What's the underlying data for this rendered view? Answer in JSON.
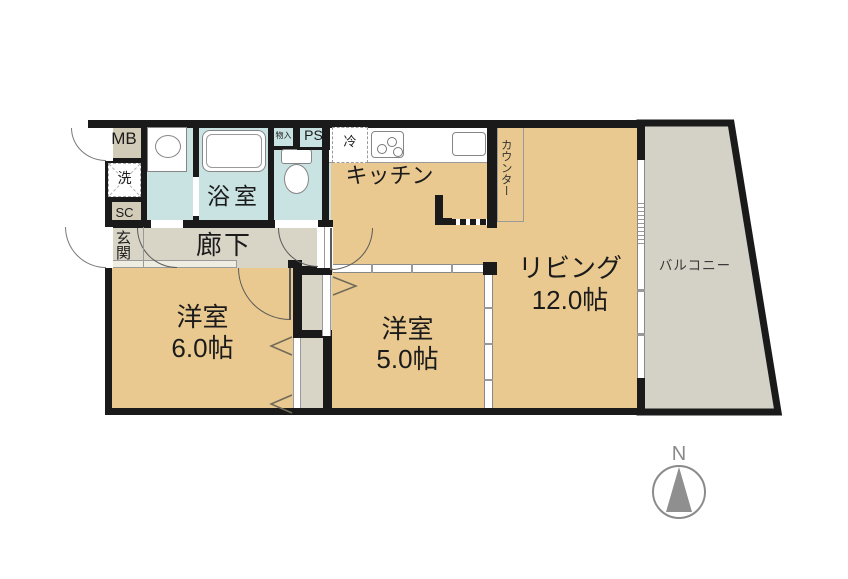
{
  "rooms": {
    "living": {
      "name": "リビング",
      "size": "12.0帖"
    },
    "bedroom_a": {
      "name": "洋室",
      "size": "6.0帖"
    },
    "bedroom_b": {
      "name": "洋室",
      "size": "5.0帖"
    },
    "kitchen": {
      "name": "キッチン"
    },
    "bathroom": {
      "name": "浴室"
    },
    "hallway": {
      "name": "廊下"
    },
    "entrance": {
      "name": "玄関"
    },
    "balcony": {
      "name": "バルコニー"
    }
  },
  "features": {
    "counter": "カウンター",
    "meter_box": "MB",
    "washing_machine": "洗",
    "shoe_cabinet": "SC",
    "pipe_space": "PS",
    "refrigerator": "冷",
    "small_closet": "物入"
  },
  "compass": {
    "north": "N"
  },
  "colors": {
    "wall": "#1A1A1A",
    "room_floor": "#E9C98F",
    "hallway_floor": "#D9D5C6",
    "utility": "#D2CBB8",
    "wet_area": "#C8E3E2",
    "balcony_floor": "#D4D1C6"
  }
}
